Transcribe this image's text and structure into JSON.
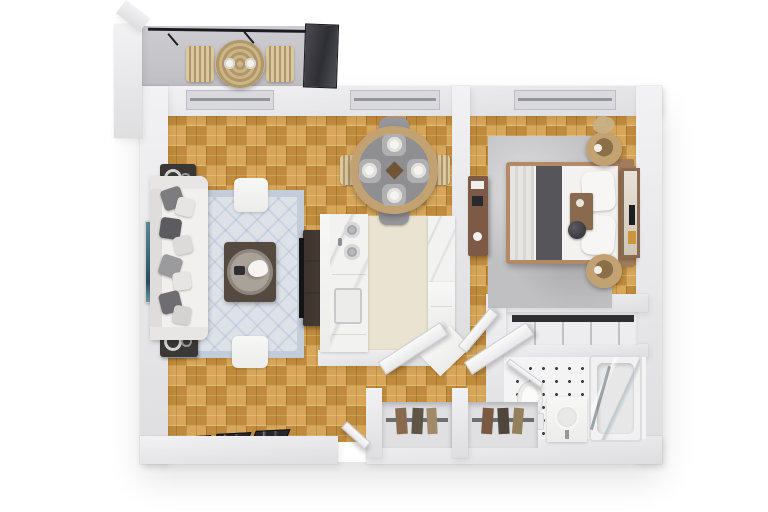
{
  "scene": {
    "type": "3d-floor-plan-render",
    "description": "Top-down 3D render of a one-bedroom apartment: balcony with bistro set, living room with sofa and rug, round dining table, galley kitchen, bedroom with queen bed, walk-in closet, bathroom, and two hall closets with open doors",
    "width": 768,
    "height": 512
  },
  "palette": {
    "background": "#ffffff",
    "wall": "#e7e7ea",
    "floor_wood": "#d09a46",
    "floor_kitchen": "#e9e4d1",
    "floor_balcony": "#c2c2c6",
    "floor_bath": "#f4f4f5",
    "rug_living": "#dde2e9",
    "rug_living_border": "#c3cdd9",
    "rug_bedroom": "#c0c0c2",
    "marble": "#f2f2f0",
    "sofa": "#f1f0ee",
    "dark_wood": "#554a40",
    "tv_black": "#141414",
    "art_teal": "#416d7c",
    "bed_white": "#f3f2f0",
    "bed_runner": "#55555a",
    "bed_frame": "#b28a68",
    "rattan": "#c2a273",
    "dresser_wood": "#7c5a45",
    "railing": "#1c1c1e",
    "doormat": "#27272c",
    "closet_rod": "#2e2e33",
    "dot_tile": "#3c3c40",
    "chair_gray": "#95959a"
  },
  "rooms": [
    {
      "id": "balcony",
      "objects": [
        "black-railing",
        "privacy-panel",
        "round-bistro-table",
        "patio-chair",
        "patio-chair"
      ]
    },
    {
      "id": "living-room",
      "objects": [
        "sofa",
        "throw-pillows",
        "teal-wall-art",
        "side-table",
        "side-table",
        "patterned-area-rug",
        "coffee-table-with-tray",
        "white-ottoman",
        "white-ottoman",
        "tv-console",
        "tv-screen",
        "doormats"
      ]
    },
    {
      "id": "dining-nook",
      "objects": [
        "round-rattan-dining-table",
        "dining-chair-x4",
        "place-setting-x4"
      ]
    },
    {
      "id": "kitchen",
      "objects": [
        "left-counter-with-sink-and-oven",
        "right-counter",
        "corner-cabinet"
      ]
    },
    {
      "id": "bedroom",
      "objects": [
        "queen-bed",
        "dark-bed-runner",
        "breakfast-tray",
        "round-nightstand",
        "round-nightstand",
        "tall-dresser",
        "leaning-mirror",
        "gray-area-rug",
        "window"
      ]
    },
    {
      "id": "walk-in-closet",
      "objects": [
        "hanging-rod",
        "wire-shelving"
      ]
    },
    {
      "id": "bathroom",
      "objects": [
        "toilet",
        "vanity-sink",
        "glass-shower-tub",
        "dotted-tile-floor"
      ]
    },
    {
      "id": "hallway",
      "objects": [
        "entry-door",
        "bedroom-door",
        "closet-with-open-door",
        "closet-with-open-door"
      ]
    }
  ]
}
